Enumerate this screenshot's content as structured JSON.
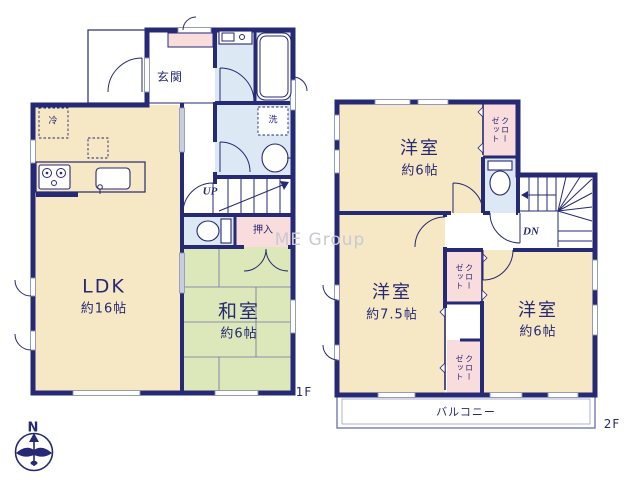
{
  "watermark": "ME Group",
  "compass": {
    "north_label": "N"
  },
  "floor1": {
    "label": "1F",
    "ldk": {
      "name": "LDK",
      "size": "約16帖"
    },
    "washitsu": {
      "name": "和室",
      "size": "約6帖"
    },
    "genkan": {
      "name": "玄関"
    },
    "oshiire": {
      "name": "押入"
    },
    "laundry_mark": "洗",
    "fridge_mark": "冷",
    "stairs_label": "UP"
  },
  "floor2": {
    "label": "2F",
    "bedroom_north": {
      "name": "洋室",
      "size": "約6帖"
    },
    "bedroom_west": {
      "name": "洋室",
      "size": "約7.5帖"
    },
    "bedroom_east": {
      "name": "洋室",
      "size": "約6帖"
    },
    "closet_north": {
      "line1": "クロー",
      "line2": "ゼット"
    },
    "closet_mid": {
      "line1": "クロー",
      "line2": "ゼット"
    },
    "closet_south": {
      "line1": "クロー",
      "line2": "ゼット"
    },
    "balcony": {
      "name": "バルコニー"
    },
    "stairs_label": "DN"
  },
  "colors": {
    "wall_navy": "#262973",
    "room_cream": "#f6e8c4",
    "tatami_green": "#dce8ba",
    "closet_pink": "#f9dcdc",
    "wet_area_blue": "#dce8f4",
    "window_gray": "#c9cede",
    "watermark_gray": "#c8c9d3"
  }
}
